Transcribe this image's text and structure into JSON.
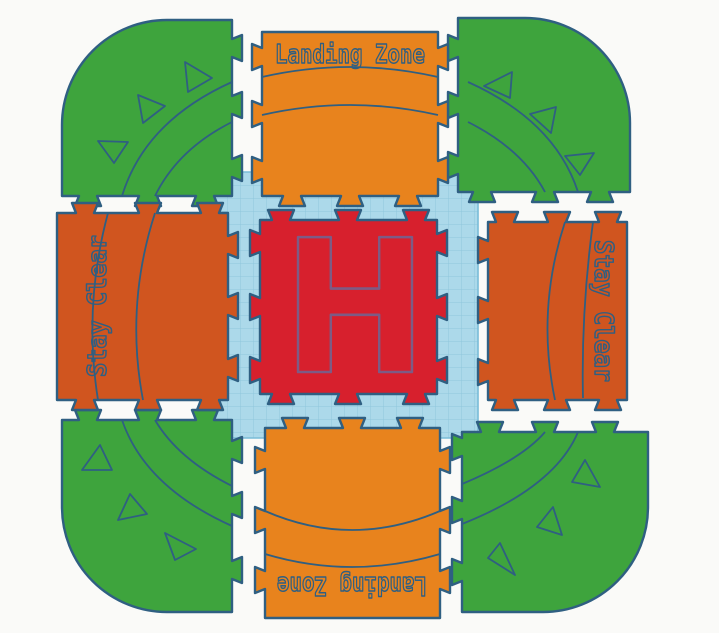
{
  "colors": {
    "background": "#FAFAF8",
    "outline": "#2F5F82",
    "landing_tile": "#E8831D",
    "stay_clear_tile": "#D0551F",
    "corner_tile": "#3EA43D",
    "helipad_tile": "#D7202D",
    "helipad_marking": "#7D5B85",
    "grid_fill": "#ACD9EA",
    "grid_line": "#8FC6DC",
    "grid_border": "#79BCD8"
  },
  "tiles": {
    "top": {
      "label": "Landing Zone"
    },
    "bottom": {
      "label": "Landing Zone"
    },
    "left": {
      "label": "Stay Clear"
    },
    "right": {
      "label": "Stay Clear"
    },
    "center": {
      "marking": "H"
    }
  }
}
